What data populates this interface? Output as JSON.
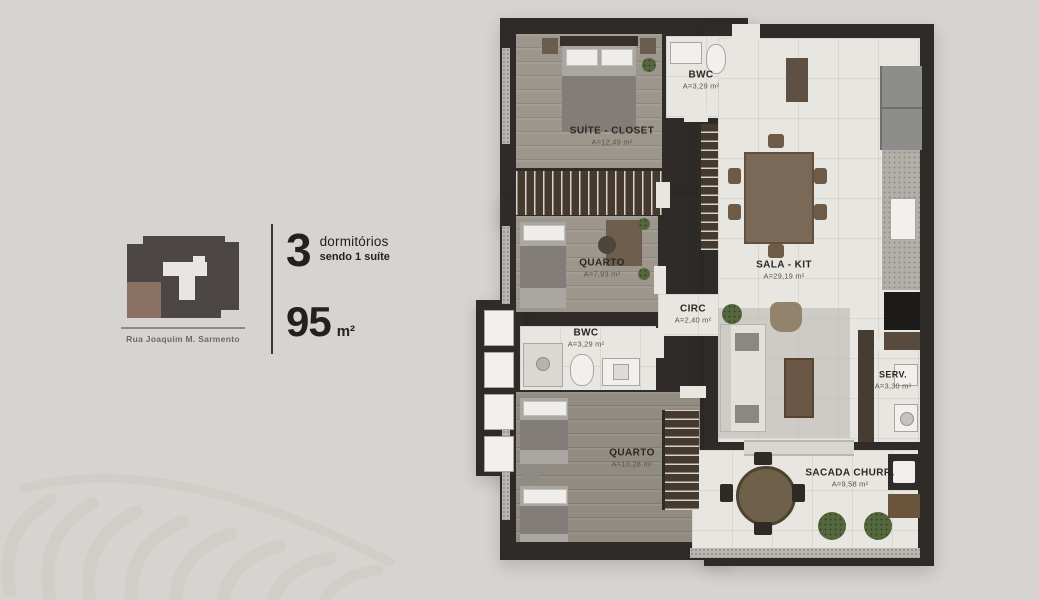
{
  "colors": {
    "background": "#d6d4d0",
    "wall": "#2e2b28",
    "wood_floor": "#9d968d",
    "tile_floor": "#e8e6e1",
    "accent_brown": "#8a7163"
  },
  "location": {
    "street": "Rua Joaquim M. Sarmento"
  },
  "specs": {
    "bedrooms": "3",
    "bedrooms_label": "dormitórios",
    "bedrooms_note": "sendo 1 suíte",
    "area": "95",
    "area_unit": "m²"
  },
  "rooms": {
    "suite": {
      "name": "SUÍTE - CLOSET",
      "area": "A=12,49 m²"
    },
    "bwc1": {
      "name": "BWC",
      "area": "A=3,29 m²"
    },
    "quarto1": {
      "name": "QUARTO",
      "area": "A=7,93 m²"
    },
    "circ": {
      "name": "CIRC",
      "area": "A=2,40 m²"
    },
    "bwc2": {
      "name": "BWC",
      "area": "A=3,29 m²"
    },
    "quarto2": {
      "name": "QUARTO",
      "area": "A=10,28 m²"
    },
    "sala": {
      "name": "SALA - KIT",
      "area": "A=29,19 m²"
    },
    "serv": {
      "name": "SERV.",
      "area": "A=3,30 m²"
    },
    "sacada": {
      "name": "SACADA CHURR.",
      "area": "A=9,58 m²"
    }
  }
}
